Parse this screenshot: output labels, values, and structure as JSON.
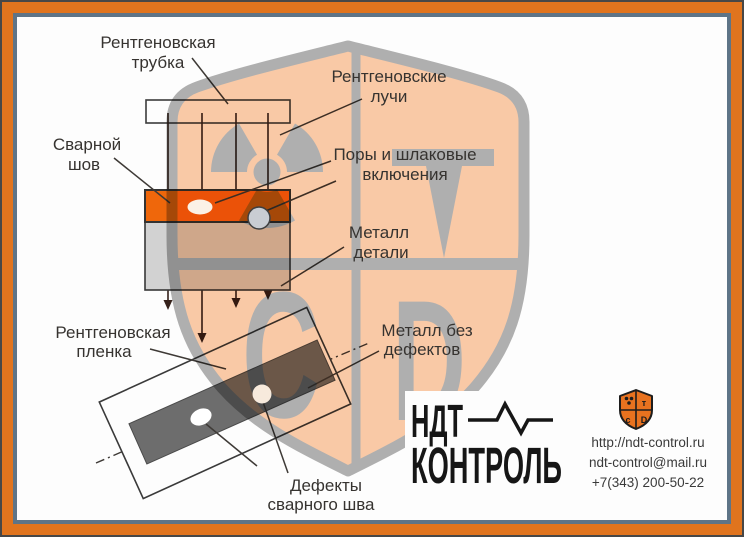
{
  "labels": {
    "xray_tube": {
      "line1": "Рентгеновская",
      "line2": "трубка"
    },
    "xray_rays": {
      "line1": "Рентгеновские",
      "line2": "лучи"
    },
    "weld_seam": {
      "line1": "Сварной",
      "line2": "шов"
    },
    "pores": {
      "line1": "Поры и шлаковые",
      "line2": "включения"
    },
    "metal_part": {
      "line1": "Металл",
      "line2": "детали"
    },
    "xray_film": {
      "line1": "Рентгеновская",
      "line2": "пленка"
    },
    "metal_no_defects": {
      "line1": "Металл без",
      "line2": "дефектов"
    },
    "weld_defects": {
      "line1": "Дефекты",
      "line2": "сварного шва"
    }
  },
  "watermark": {
    "letter_t": "Т",
    "letter_c": "С",
    "letter_d": "D",
    "symbols": [
      "radiation-trefoil",
      "Т",
      "С",
      "D"
    ]
  },
  "logo": {
    "line1": "НДТ",
    "line2": "КОНТРОЛЬ",
    "shield_tr": "т",
    "shield_bl": "с",
    "shield_br": "D"
  },
  "contact": {
    "website": "http://ndt-control.ru",
    "email": "ndt-control@mail.ru",
    "phone": "+7(343) 200-50-22"
  },
  "colors": {
    "frame_dark": "#474747",
    "frame_orange": "#E0741E",
    "frame_slate": "#5E7487",
    "weld_orange": "#F1680B",
    "metal_gray": "#D4D4D4",
    "film_strip_gray": "#6E6E6E",
    "shield_peach": "#F9C9A6",
    "shield_gray": "#AFAFAF",
    "logo_black": "#161616"
  }
}
